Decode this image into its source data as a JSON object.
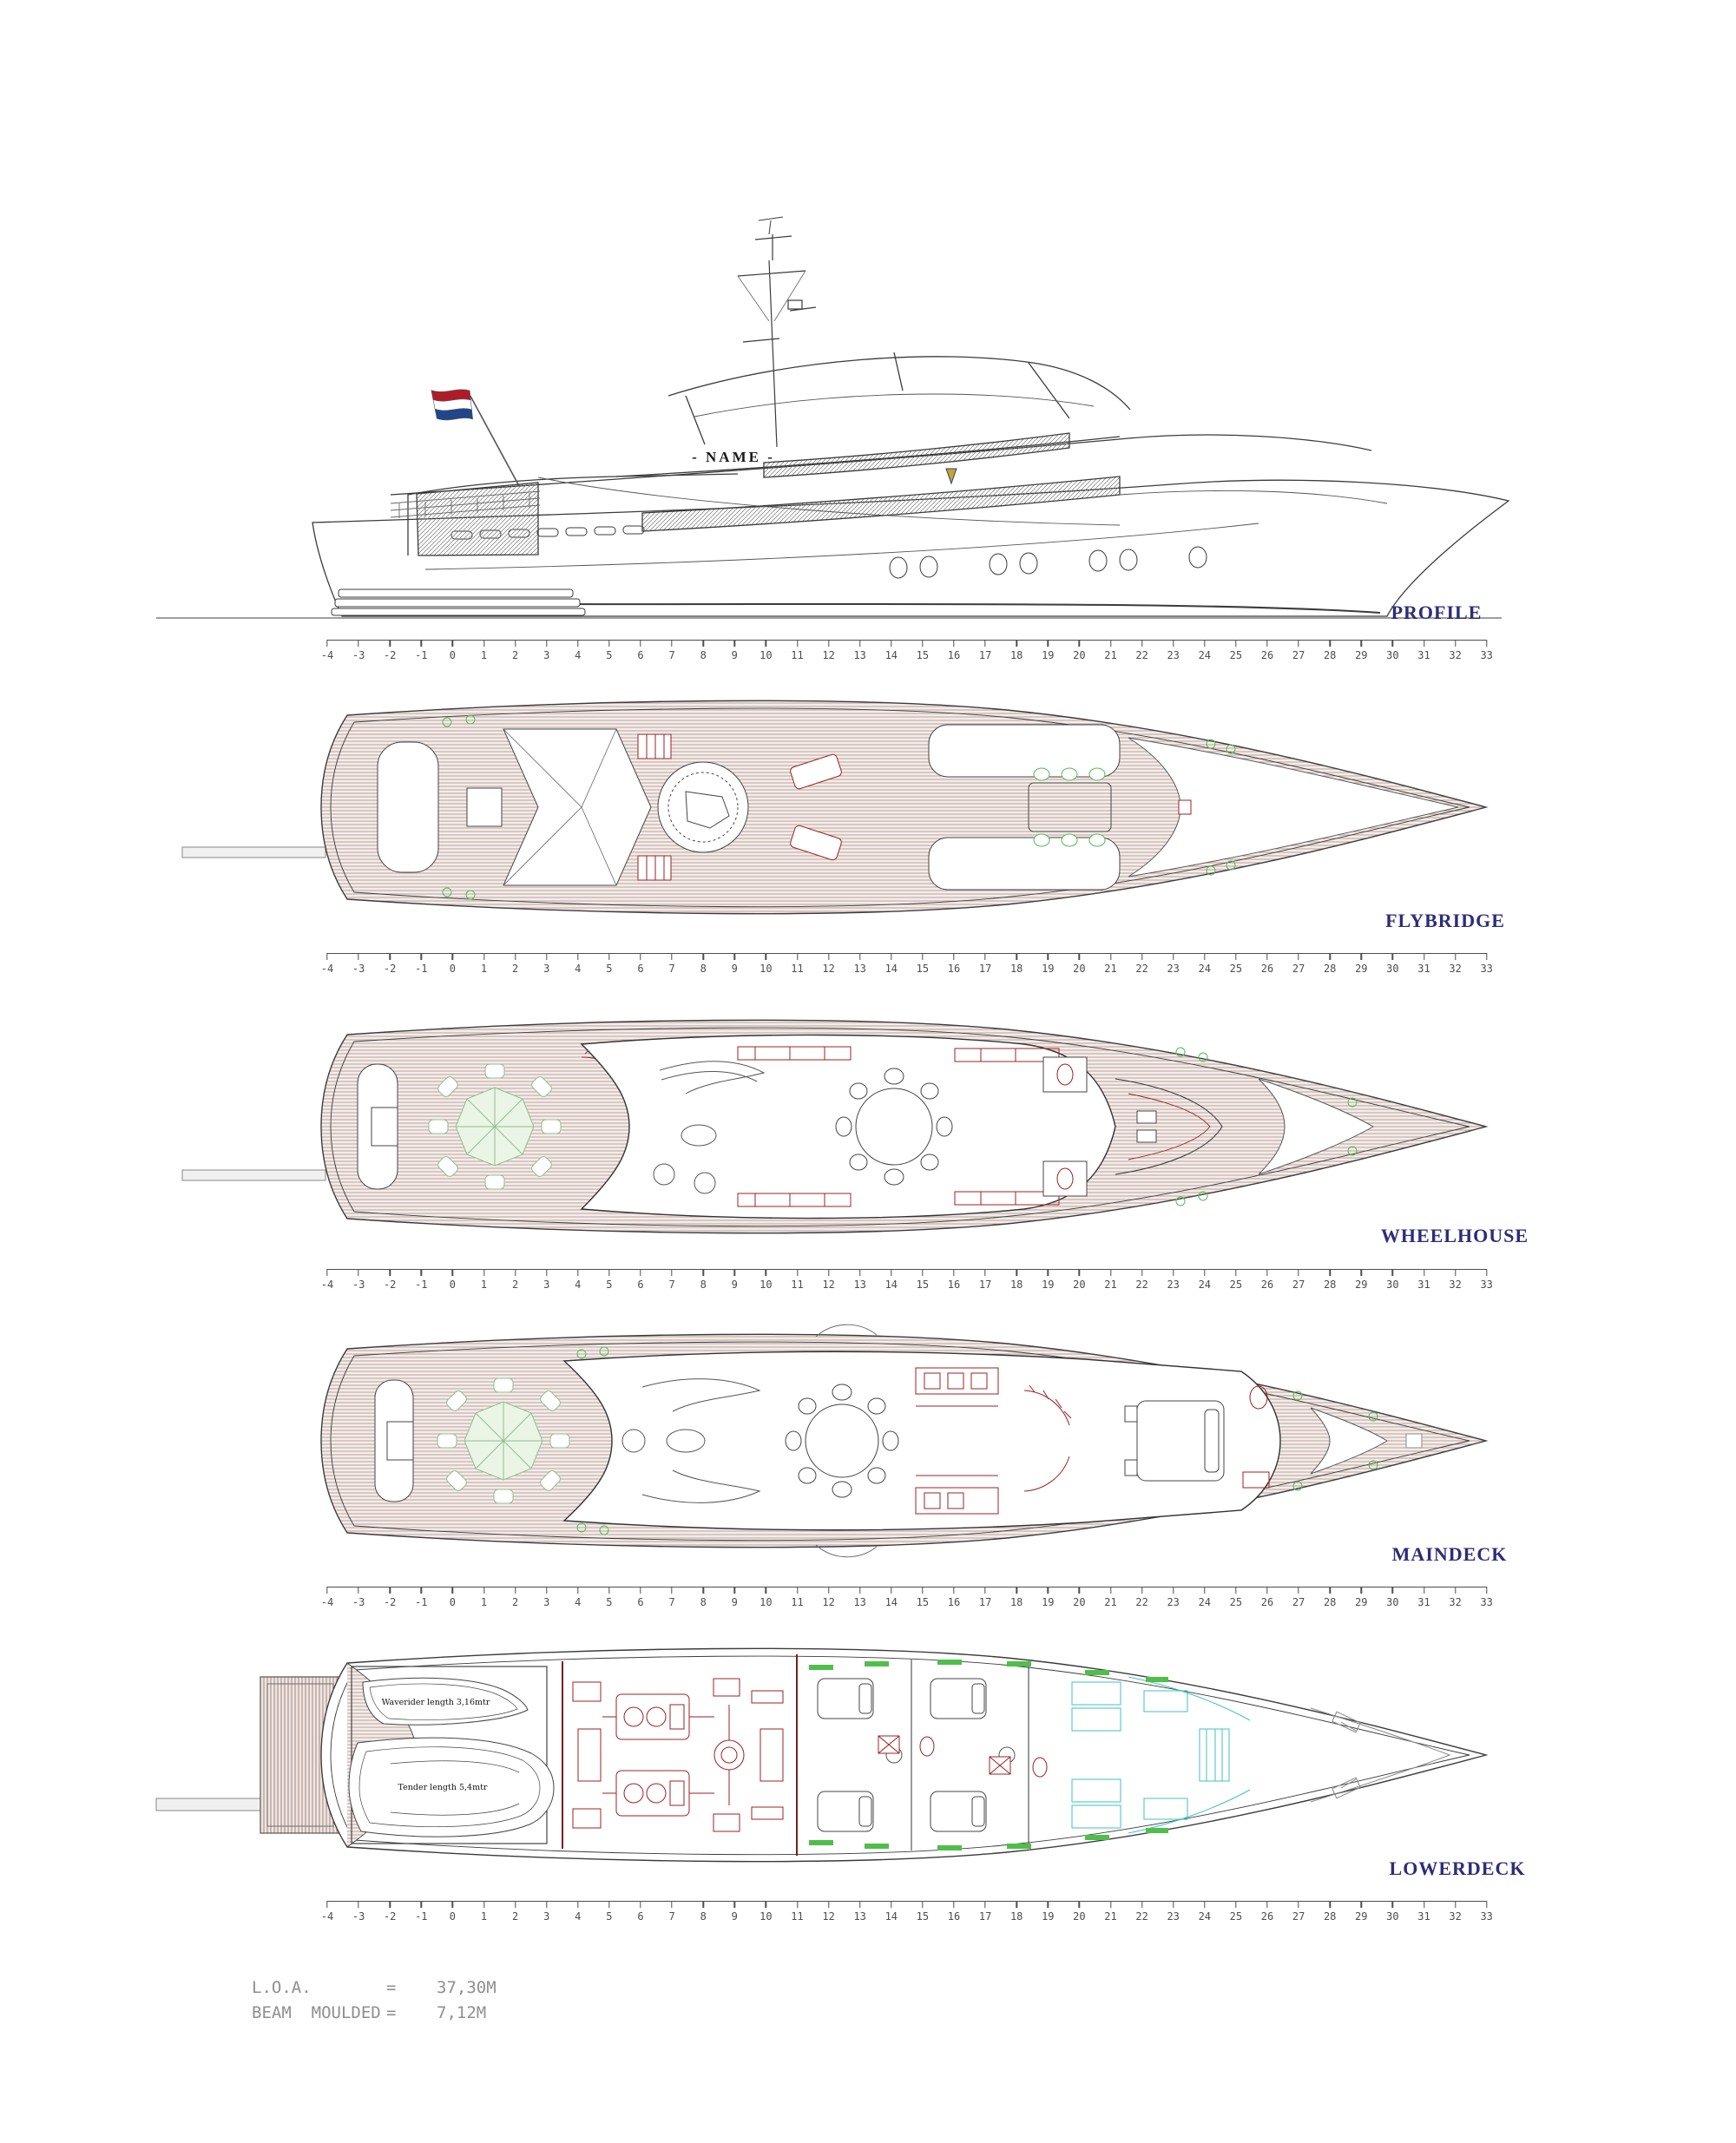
{
  "vessel": {
    "name_plate": "- NAME -"
  },
  "views": {
    "profile": {
      "label": "PROFILE"
    },
    "flybridge": {
      "label": "FLYBRIDGE"
    },
    "wheelhouse": {
      "label": "WHEELHOUSE"
    },
    "maindeck": {
      "label": "MAINDECK"
    },
    "lowerdeck": {
      "label": "LOWERDECK"
    }
  },
  "ruler": {
    "start": -4,
    "end": 33
  },
  "garage": {
    "waverider": "Waverider length 3,16mtr",
    "tender": "Tender length 5,4mtr"
  },
  "specs": {
    "rows": [
      {
        "label": "L.O.A.",
        "eq": "=",
        "value": "37,30M"
      },
      {
        "label": "BEAM  MOULDED",
        "eq": "=",
        "value": "7,12M"
      }
    ]
  },
  "colors": {
    "label_navy": "#2d2d7b",
    "ruler_gray": "#4d4d4d",
    "teak_line": "#b49c96",
    "detail_red": "#9e2020",
    "accent_green": "#55bb55",
    "accent_cyan": "#3fc1c1",
    "flag_red": "#ae1c28",
    "flag_blue": "#21468b",
    "spec_gray": "#8f8f8f"
  }
}
